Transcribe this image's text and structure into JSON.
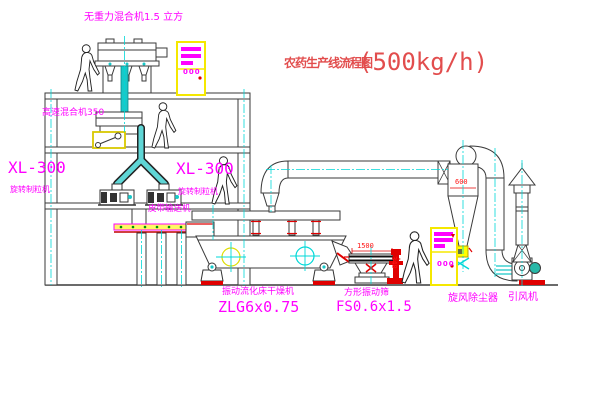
{
  "title": {
    "name": "农药生产线流程图",
    "capacity": "(500kg/h)"
  },
  "labels": {
    "gravity_mixer": "无重力混合机1.5 立方",
    "high_speed_mixer": "高速混合机350",
    "granulator_model": "XL-300",
    "granulator_name": "旋转制粒机",
    "belt_conveyor": "皮带输送机",
    "dryer_name": "振动流化床干燥机",
    "dryer_model": "ZLG6x0.75",
    "screen_name": "方形振动筛",
    "screen_model": "FS0.6x1.5",
    "cyclone": "旋风除尘器",
    "fan": "引风机"
  },
  "dimensions": {
    "screen_length": "1500",
    "screen_height": "340",
    "cyclone_width": "600"
  },
  "cabinets": {
    "indicator": "000"
  },
  "colors": {
    "label_magenta": "#ff00ff",
    "title_red": "#e24d4d",
    "dimension_red": "#ff1414",
    "centerline_cyan": "#00d8d8",
    "pipe_teal": "#18c8c8",
    "cabinet_yellow": "#f5e800",
    "line_dark": "#3a3a3a"
  }
}
